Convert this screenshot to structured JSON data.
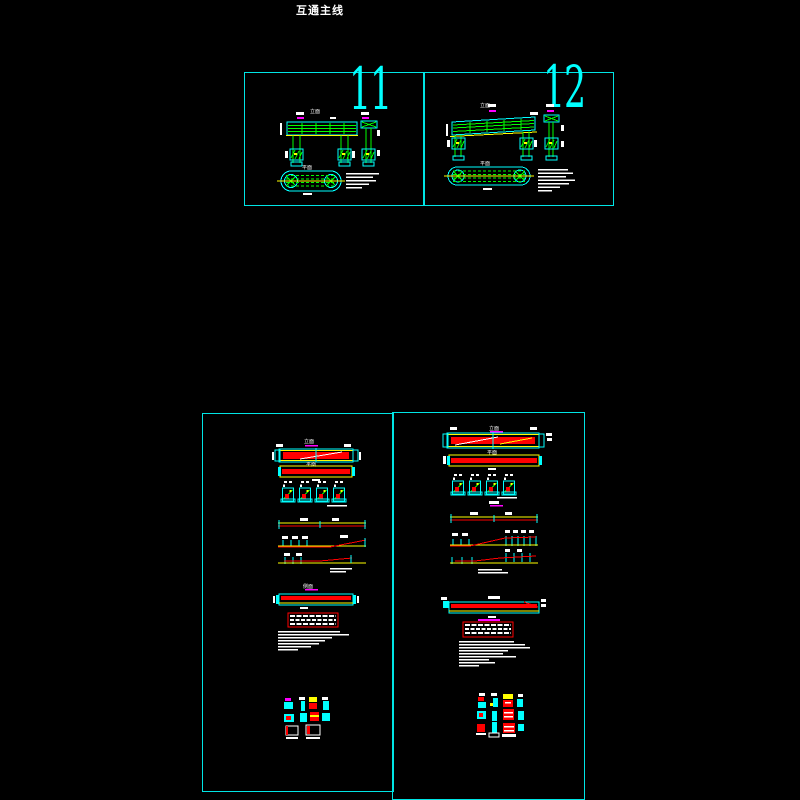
{
  "page": {
    "title": "互通主线",
    "background": "#000000"
  },
  "colors": {
    "frame_cyan": "#00ffff",
    "linework_green": "#00ff00",
    "rebar_red": "#ff0000",
    "dimension_yellow": "#ffff00",
    "bearing_magenta": "#ff00ff",
    "text_white": "#ffffff"
  },
  "view_labels": {
    "elevation": "立面",
    "plan": "平面",
    "side": "侧面"
  },
  "panels": {
    "top_left": {
      "number": "11"
    },
    "top_right": {
      "number": "12"
    },
    "bottom_left": {
      "number": ""
    },
    "bottom_right": {
      "number": ""
    }
  }
}
